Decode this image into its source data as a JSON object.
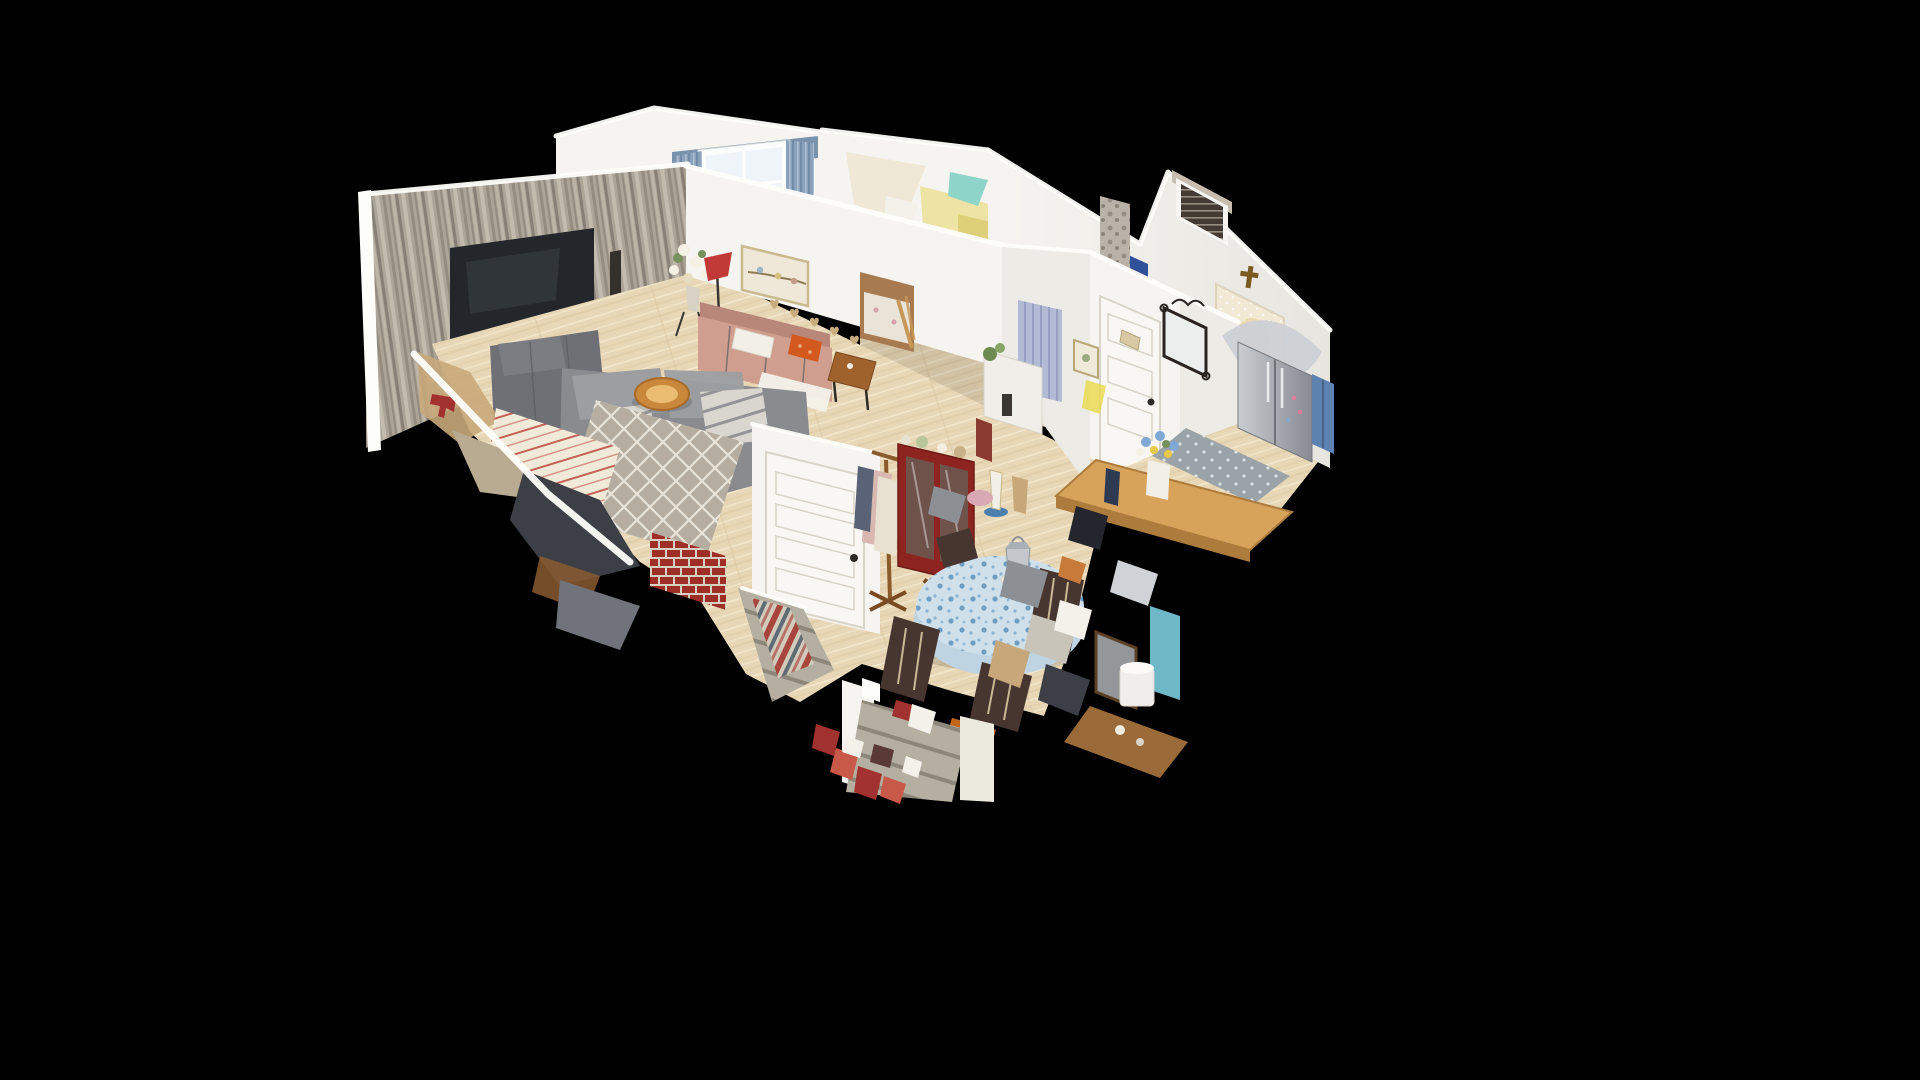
{
  "viewport": {
    "description": "isometric 3D dollhouse cutaway view of a furnished single-story home floating on a black background",
    "view_mode": "dollhouse",
    "background": "#000000"
  },
  "rooms": {
    "living_room": {
      "label": "living room",
      "items": [
        "rustic plank accent wall",
        "wall tv",
        "wood stove console",
        "gray recliner",
        "gray sectional sofa",
        "striped throws",
        "trellis rug",
        "tree-slice coffee table"
      ]
    },
    "bedroom_1": {
      "label": "bedroom",
      "items": [
        "curtained window",
        "tufted mauve headboard",
        "wall sconce",
        "basket"
      ]
    },
    "sitting_area": {
      "label": "sitting area",
      "items": [
        "rose futon sofa",
        "white pillow",
        "orange pillow",
        "bird picture",
        "heart garland",
        "red floor lamp",
        "white flowers",
        "end table"
      ]
    },
    "bedroom_2": {
      "label": "second bedroom",
      "items": [
        "floral bed through doorway",
        "wooden ladder"
      ]
    },
    "bathroom": {
      "label": "bathroom",
      "items": [
        "lavender shower curtain",
        "glitched ceiling mesh",
        "pebble column"
      ]
    },
    "dining_room": {
      "label": "dining room",
      "items": [
        "round table with blue floral cloth",
        "silver lantern centerpiece",
        "dark wood chairs",
        "red china cabinet",
        "coat rack",
        "white panel door",
        "orange stool",
        "striped runner"
      ]
    },
    "kitchen_entry": {
      "label": "kitchen and entry",
      "items": [
        "stainless fridge",
        "blue cabinets",
        "white panel door",
        "ornate black mirror",
        "wall cross",
        "lace curtained window",
        "window with blinds",
        "gray patterned rug",
        "wood-top island",
        "flower vase",
        "white bin",
        "teal panel",
        "vanity desk"
      ]
    },
    "stairs": {
      "label": "stairways",
      "items": [
        "basement stairs with striped runner",
        "brick hearth",
        "front stairs",
        "glitched red decorations"
      ]
    }
  },
  "colors": {
    "black": "#000000",
    "wall_white": "#f5f4f0",
    "wall_shade": "#e7e5df",
    "wall_warm": "#ecebe5",
    "trim_white": "#fdfdfa",
    "floor_wood": "#e8d7b6",
    "floor_streak_light": "#f2e7cd",
    "floor_streak_dark": "#d9c49e",
    "plank_base": "#aca496",
    "plank_dark": "#6f6860",
    "plank_mid": "#948c7e",
    "plank_light": "#cec6b8",
    "tv_screen": "#23272c",
    "tv_glow": "#4a4f57",
    "console_dark": "#3e3a35",
    "console_top": "#c9bead",
    "recliner_gray": "#6e7076",
    "sofa_gray": "#898b8f",
    "sofa_cushion": "#9c9ea2",
    "throw_light": "#d9d6cf",
    "throw_dark": "#666870",
    "rug_trellis_base": "#b5aea0",
    "rug_trellis_line": "#e8e4da",
    "tree_slice": "#c9883c",
    "tree_slice_center": "#eabd72",
    "brick_red": "#9e2f26",
    "mortar": "#d9cfc3",
    "futon_rose": "#cf9e8e",
    "futon_shadow": "#b8877a",
    "pillow_white": "#f2efe7",
    "pillow_orange": "#d4591f",
    "end_table_wood": "#a0622d",
    "lamp_red": "#c23a38",
    "flower_white": "#f4f0e4",
    "curtain_blue": "#8aa2bc",
    "curtain_blue_dark": "#6d88a4",
    "window_bright": "#eef4f8",
    "headboard_mauve": "#9c7484",
    "sconce_amber": "#d8a835",
    "ceiling_yellow": "#ece3a4",
    "teal_glitch": "#8fd4c8",
    "teal_panel": "#6fb8c8",
    "shower_lavender": "#b3bad6",
    "pebble_gray": "#b8b2a8",
    "dark_blue": "#31509a",
    "blinds_dark": "#433b33",
    "lace_cream": "#f2e9d5",
    "lace_glow": "#e6cd8d",
    "cross_gold": "#7a5a20",
    "steel_light": "#c9cdd2",
    "steel_dark": "#878b91",
    "blue_cabinet": "#5d82b0",
    "door_white": "#f8f7f3",
    "door_shadow": "#d8d4ca",
    "mirror_black": "#2a2420",
    "rug_gray": "#9aa4a8",
    "rug_gray_dot": "#e2e6e8",
    "wood_top": "#d7a259",
    "wood_top_edge": "#ad7c3c",
    "flower_blue": "#7fa8d4",
    "flower_yellow": "#e8c848",
    "greenery": "#77905c",
    "cloth_blue_base": "#cfe0ea",
    "cloth_blue_dot": "#6f9ec4",
    "cloth_skirt": "#bfd4e2",
    "lantern_steel": "#c4c8cc",
    "chair_wood": "#473530",
    "stool_orange": "#c2661c",
    "runner_red": "#a8453c",
    "runner_gray": "#5f6c76",
    "runner_cream": "#d2cabb",
    "step_gray": "#b5afa1",
    "step_shadow": "#8d877a",
    "cabinet_red": "#8e2420",
    "hall_floor_brown": "#a87a50",
    "bed_floral": "#e9e3d8",
    "ladder_wood": "#c89858",
    "statue_blue": "#4a7fae",
    "vanity_wood": "#9a6a38"
  }
}
